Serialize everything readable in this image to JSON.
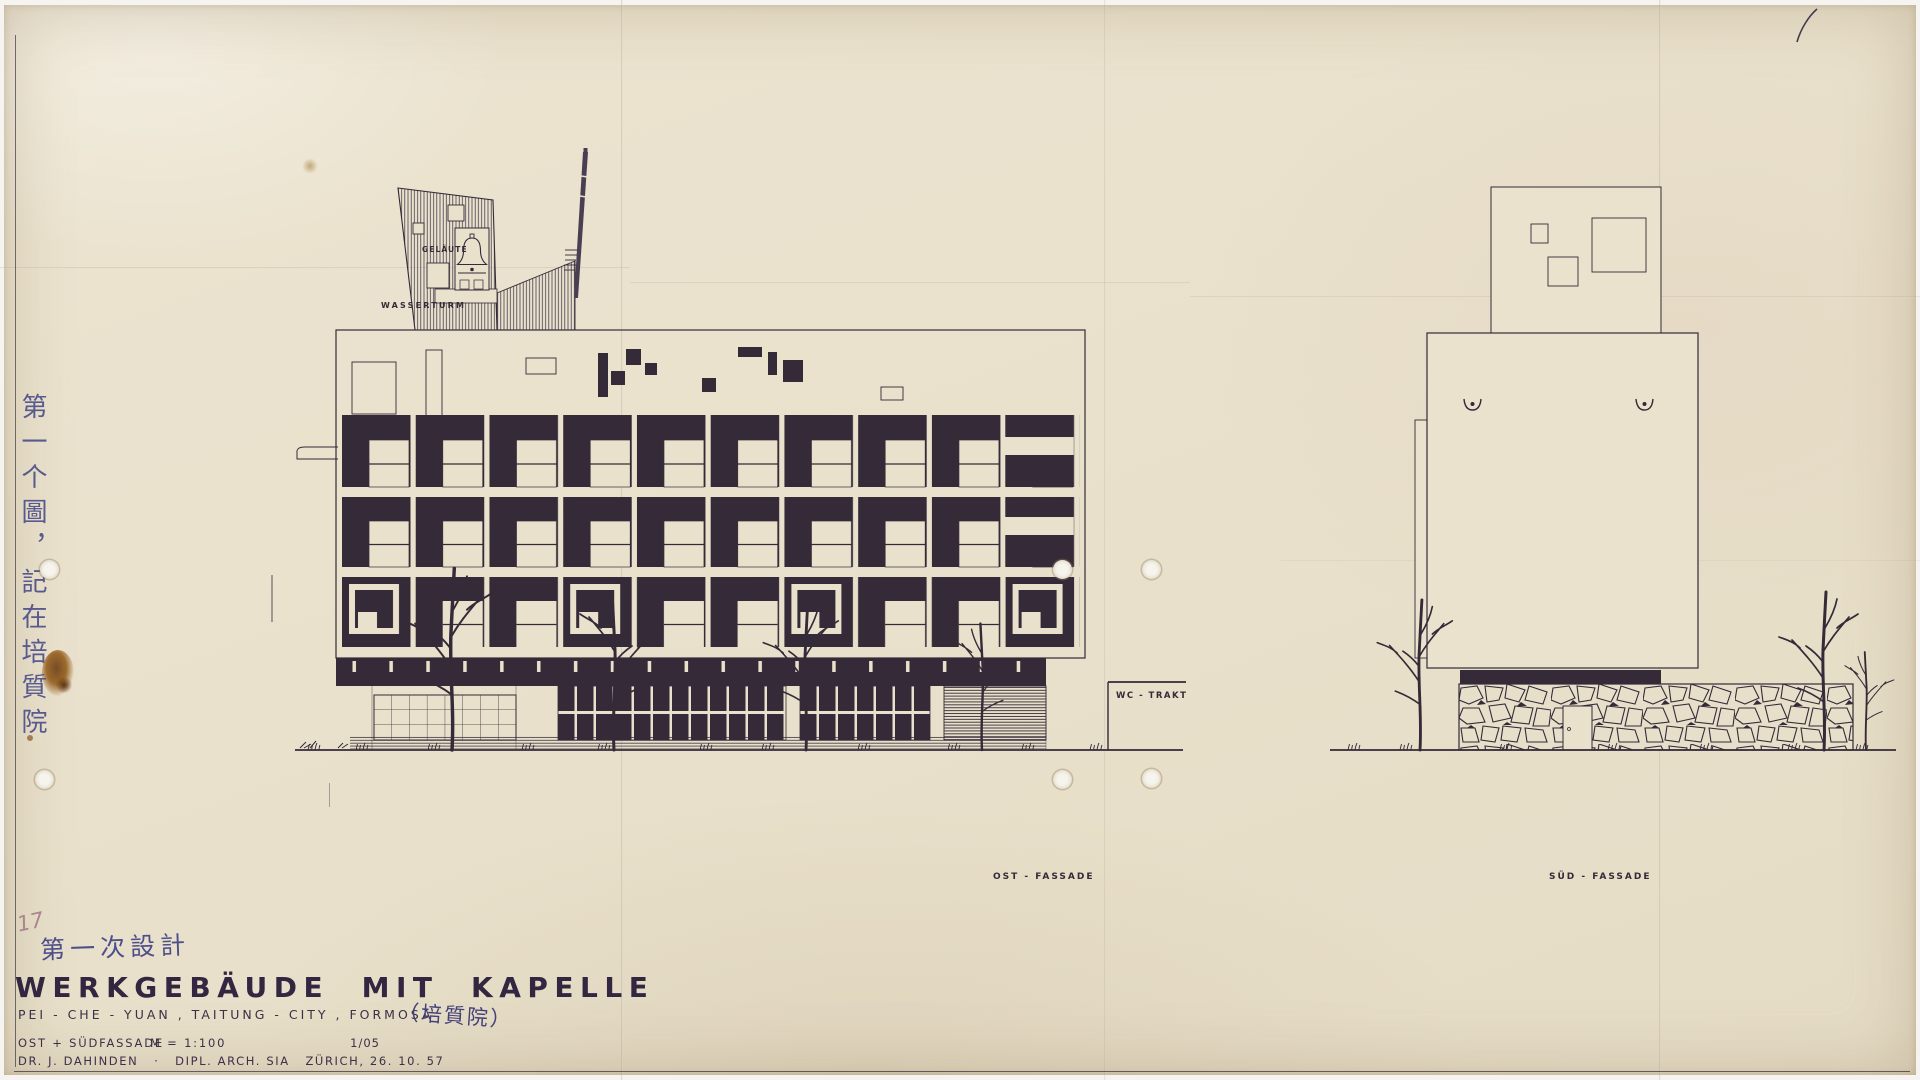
{
  "title_block": {
    "pencil_number": "17",
    "design_phase_cn": "第一次設計",
    "project_title": "WERKGEBÄUDE  MIT  KAPELLE",
    "project_location": "PEI - CHE - YUAN , TAITUNG - CITY , FORMOSA",
    "location_cn": "（培質院）",
    "drawing_name": "OST + SÜDFASSADE",
    "scale": "M = 1:100",
    "sheet_number": "1/05",
    "author": "DR. J. DAHINDEN",
    "author_credentials": "·   DIPL. ARCH. SIA   ZÜRICH, 26. 10. 57"
  },
  "annotations": {
    "margin_vertical_cn": "第一个圖，記在培質院"
  },
  "drawing_labels": {
    "bell": "GELÄUTE",
    "water_tower": "WASSERTURM",
    "wc_wing": "WC - TRAKT",
    "east_facade": "OST - FASSADE",
    "south_facade": "SÜD - FASSADE"
  },
  "colors": {
    "paper": "#e9e1cc",
    "ink": "#342a38",
    "blue_ink": "#4d4f8b",
    "stain_rust": "#8a5526"
  }
}
